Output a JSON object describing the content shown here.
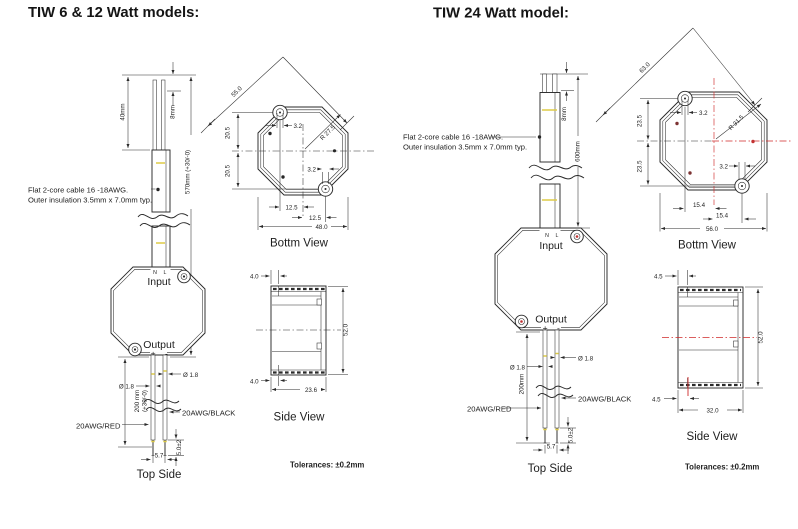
{
  "colors": {
    "ink": "#2a2a2a",
    "red_accent": "#cf2a2a",
    "maroon_dot": "#7d3333",
    "yellow_strip": "#ddca45"
  },
  "left": {
    "title": "TIW 6 & 12 Watt models:",
    "cable_note_1": "Flat 2-core cable 16 -18AWG.",
    "cable_note_2": "Outer insulation 3.5mm x 7.0mm typ.",
    "dim_strip": "40mm",
    "dim_tip": "8mm",
    "dim_cable": "570mm (+30/-0)",
    "body": {
      "terminals": "N L",
      "input": "Input",
      "output": "Output",
      "polarity": "+ -"
    },
    "dim_dia_l": "Ø 1.8",
    "dim_dia_r": "Ø 1.8",
    "dim_out_len": "200 mm",
    "dim_out_tol": "(+30/-0)",
    "wire_red": "20AWG/RED",
    "wire_black": "20AWG/BLACK",
    "dim_pitch": "5.7",
    "dim_tip_strip": "5.0±2",
    "top_side": "Top Side",
    "bv": {
      "label": "Bottm View",
      "diag": "55.0",
      "radius": "R 27.5",
      "off_top": "3.2",
      "off_bot": "3.2",
      "v1": "20.5",
      "v2": "20.5",
      "h1": "12.5",
      "h2": "12.5",
      "width": "48.0"
    },
    "sv": {
      "label": "Side View",
      "f_top": "4.0",
      "f_bot": "4.0",
      "depth": "23.6",
      "height": "52.0"
    },
    "tolerance": "Tolerances: ±0.2mm"
  },
  "right": {
    "title": "TIW 24 Watt model:",
    "cable_note_1": "Flat 2-core cable 16 -18AWG.",
    "cable_note_2": "Outer insulation 3.5mm x 7.0mm typ.",
    "dim_tip": "8mm",
    "dim_cable": "600mm",
    "body": {
      "terminals": "N L",
      "input": "Input",
      "output": "Output",
      "polarity": "+ -"
    },
    "dim_dia_l": "Ø 1.8",
    "dim_dia_r": "Ø 1.8",
    "dim_out_len": "200mm",
    "wire_red": "20AWG/RED",
    "wire_black": "20AWG/BLACK",
    "dim_pitch": "5.7",
    "dim_tip_strip": "5.0±2",
    "top_side": "Top Side",
    "bv": {
      "label": "Bottm View",
      "diag": "63.0",
      "radius": "R 31.5",
      "off_top": "3.2",
      "off_bot": "3.2",
      "v1": "23.5",
      "v2": "23.5",
      "h1": "15.4",
      "h2": "15.4",
      "width": "56.0"
    },
    "sv": {
      "label": "Side View",
      "f_top": "4.5",
      "f_bot": "4.5",
      "depth": "32.0",
      "height": "52.0"
    },
    "tolerance": "Tolerances: ±0.2mm"
  }
}
